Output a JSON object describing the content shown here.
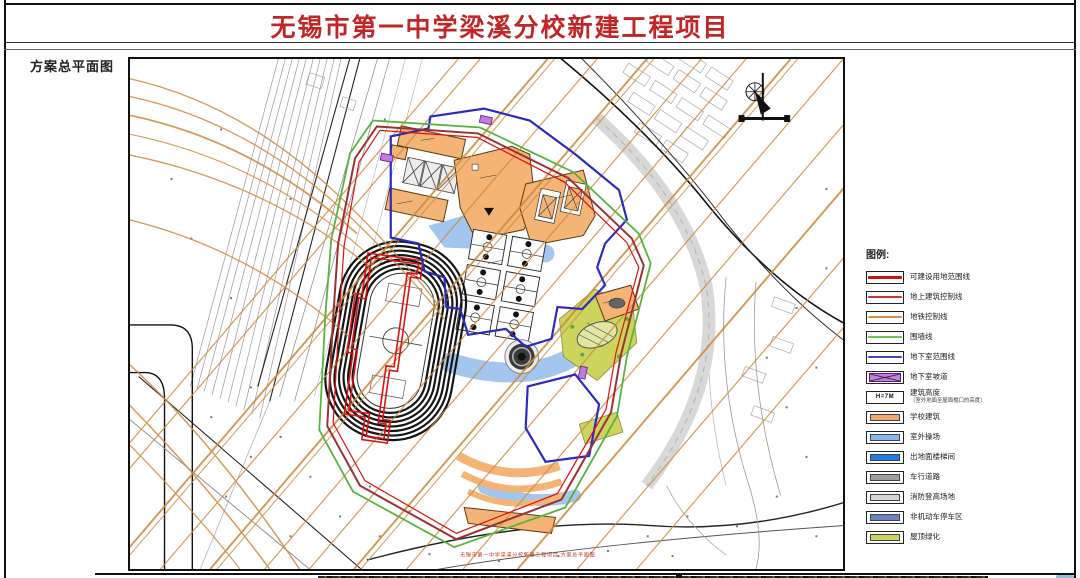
{
  "sheet": {
    "title": "无锡市第一中学梁溪分校新建工程项目",
    "scheme_label": "方案总平面图",
    "bottom_caption": "无锡市第一中学梁溪分校新建工程项目 方案总平面图"
  },
  "palette": {
    "title_red": "#c22525",
    "metro_orange": "#cc8a3f",
    "boundary_red": "#dd1111",
    "building_control_red": "#993333",
    "fence_green": "#58b33c",
    "basement_blue": "#2a2ac0",
    "school_building_orange": "#f4b476",
    "platform_blue": "#a3c6ee",
    "roof_green": "#ccd45e"
  },
  "legend": {
    "title": "图例:",
    "items": [
      {
        "label": "可建设用地范围线",
        "type": "line",
        "color": "#cc1111",
        "thickness": 3
      },
      {
        "label": "地上建筑控制线",
        "type": "line",
        "color": "#cc3333",
        "thickness": 2
      },
      {
        "label": "地铁控制线",
        "type": "line",
        "color": "#d89048",
        "thickness": 2
      },
      {
        "label": "围墙线",
        "type": "line",
        "color": "#6fc24a",
        "thickness": 2
      },
      {
        "label": "地下室范围线",
        "type": "line",
        "color": "#4444bb",
        "thickness": 1.5
      },
      {
        "label": "地下室坡道",
        "type": "hatch",
        "color": "#c97fe0"
      },
      {
        "label": "建筑高度",
        "note": "（室外地面至屋面檐口的高度）",
        "type": "height",
        "sample": "H=7M"
      },
      {
        "label": "学校建筑",
        "type": "fill",
        "color": "#f4a76a"
      },
      {
        "label": "室外操场",
        "type": "fill",
        "color": "#85b7f0"
      },
      {
        "label": "出地面楼梯间",
        "type": "fill",
        "color": "#1e7ce8"
      },
      {
        "label": "车行道路",
        "type": "fill",
        "color": "#9e9e9e"
      },
      {
        "label": "消防登高场地",
        "type": "fill",
        "color": "#d6d6d6"
      },
      {
        "label": "非机动车停车区",
        "type": "fill",
        "color": "#6b84c8"
      },
      {
        "label": "屋顶绿化",
        "type": "fill",
        "color": "#ccd45e"
      }
    ]
  }
}
